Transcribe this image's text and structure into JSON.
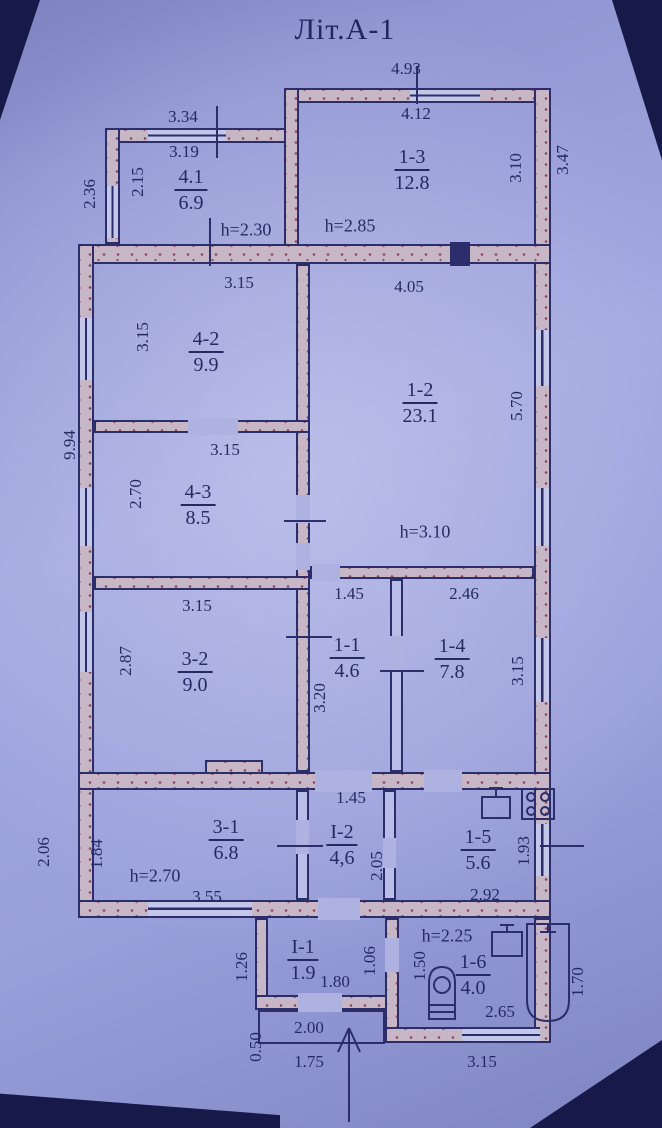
{
  "title": "Літ.А-1",
  "colors": {
    "paper": "#9aa0da",
    "line": "#2b2e6b",
    "wall_fill": "#c7b6c6",
    "wall_stipple": "#8d4a5e",
    "text": "#262a63",
    "photo_shadow": "#171949"
  },
  "rooms": {
    "r41": {
      "id": "4.1",
      "area": "6.9"
    },
    "r13": {
      "id": "1-3",
      "area": "12.8"
    },
    "r42": {
      "id": "4-2",
      "area": "9.9"
    },
    "r12": {
      "id": "1-2",
      "area": "23.1"
    },
    "r43": {
      "id": "4-3",
      "area": "8.5"
    },
    "r32": {
      "id": "3-2",
      "area": "9.0"
    },
    "r11": {
      "id": "1-1",
      "area": "4.6"
    },
    "r14": {
      "id": "1-4",
      "area": "7.8"
    },
    "r31": {
      "id": "3-1",
      "area": "6.8"
    },
    "rI2": {
      "id": "I-2",
      "area": "4,6"
    },
    "r15": {
      "id": "1-5",
      "area": "5.6"
    },
    "rI1": {
      "id": "I-1",
      "area": "1.9"
    },
    "r16": {
      "id": "1-6",
      "area": "4.0"
    }
  },
  "heights": {
    "annex_left": "h=2.30",
    "annex_right": "h=2.85",
    "main": "h=3.10",
    "bottom_band": "h=2.70",
    "bathroom": "h=2.25"
  },
  "dims": {
    "annex_left_top_outer": "3.34",
    "annex_left_top_inner": "3.19",
    "annex_right_top_outer": "4.93",
    "annex_right_top_inner": "4.12",
    "annex_left_side_outer": "2.36",
    "annex_left_side_inner": "2.15",
    "annex_right_side_inner": "3.10",
    "right_side_outer_top": "3.47",
    "room42_top": "3.15",
    "room12_top": "4.05",
    "room42_left": "3.15",
    "left_side_outer": "9.94",
    "room12_right": "5.70",
    "room43_top": "3.15",
    "room43_left": "2.70",
    "room32_top": "3.15",
    "room32_left": "2.87",
    "corridor11_top": "1.45",
    "room14_top": "2.46",
    "corridor11_left": "3.20",
    "room14_right": "3.15",
    "corridorI2_top": "1.45",
    "room31_bottom": "3.55",
    "room15_bottom": "2.92",
    "room31_left": "1.84",
    "bottom_left_outer": "2.06",
    "corridorI2_left": "2.05",
    "room15_right": "1.93",
    "porch_left_outer": "1.26",
    "porch_bottom": "1.80",
    "porch_right": "1.06",
    "bath_left": "1.50",
    "bath_right_outer": "1.70",
    "bath_bottom": "2.65",
    "stoop_top": "2.00",
    "stoop_left": "0.50",
    "stoop_bottom": "1.75",
    "bottom_right_outer": "3.15"
  },
  "icons": {
    "kitchen_sink": "kitchen-sink-icon",
    "stove": "stove-icon",
    "washbasin": "washbasin-icon",
    "toilet": "toilet-icon",
    "bathtub": "bathtub-icon",
    "entrance_arrow": "entrance-arrow-icon"
  }
}
